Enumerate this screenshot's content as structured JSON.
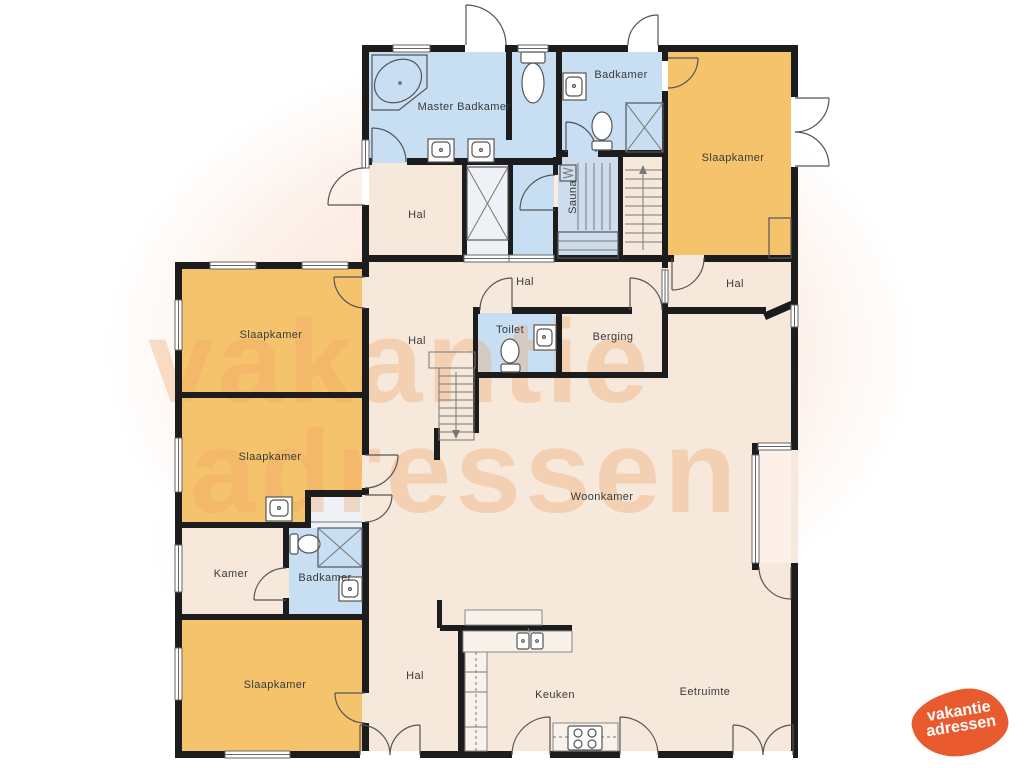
{
  "palette": {
    "wall": "#1c1c1c",
    "cream": "#f6e8db",
    "orange": "#f5c36c",
    "blue": "#c8def2",
    "sauna_blue": "#cdddee",
    "watermark": "#f0a263",
    "logo_orange": "#e95b2f"
  },
  "rooms": {
    "master_badkamer": "Master Badkamer",
    "badkamer_top": "Badkamer",
    "slaapkamer_tr": "Slaapkamer",
    "hal_top": "Hal",
    "sauna": "Sauna",
    "hal_tr": "Hal",
    "hal_small": "Hal",
    "toilet": "Toilet",
    "berging": "Berging",
    "slaapkamer_l1": "Slaapkamer",
    "hal_mid": "Hal",
    "slaapkamer_l2": "Slaapkamer",
    "kamer": "Kamer",
    "badkamer_left": "Badkamer",
    "slaapkamer_bl": "Slaapkamer",
    "woonkamer": "Woonkamer",
    "hal_bottom": "Hal",
    "keuken": "Keuken",
    "eetruimte": "Eetruimte"
  },
  "watermark": {
    "line1": "vakantie",
    "line2": "adressen"
  },
  "logo": {
    "line1": "vakantie",
    "line2": "adressen"
  }
}
